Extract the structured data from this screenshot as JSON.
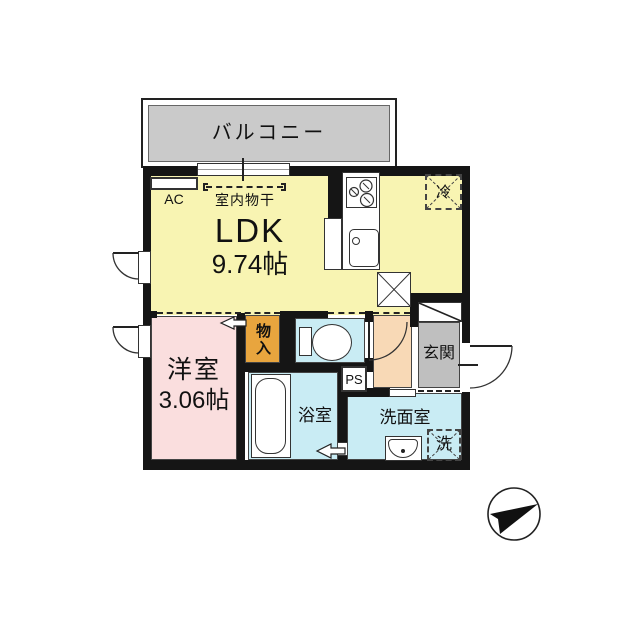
{
  "floorplan": {
    "balcony_label": "バルコニー",
    "ldk": {
      "name": "LDK",
      "size": "9.74帖",
      "ac_label": "AC",
      "indoor_drying_label": "室内物干",
      "refrigerator_label": "冷"
    },
    "western_room": {
      "name": "洋室",
      "size": "3.06帖"
    },
    "closet_label": "物入",
    "entrance_label": "玄関",
    "bathroom_label": "浴室",
    "washroom_label": "洗面室",
    "washer_label": "洗",
    "pipe_space_label": "PS"
  },
  "colors": {
    "wall": "#151515",
    "ldk_yellow": "#F8F4B2",
    "room_pink": "#FADEDE",
    "closet_orange": "#E8A53E",
    "wet_area_blue": "#C9ECF4",
    "hall_peach": "#F8D9B6",
    "entrance_gray": "#BFBFBF",
    "balcony_gray": "#CACACA"
  }
}
